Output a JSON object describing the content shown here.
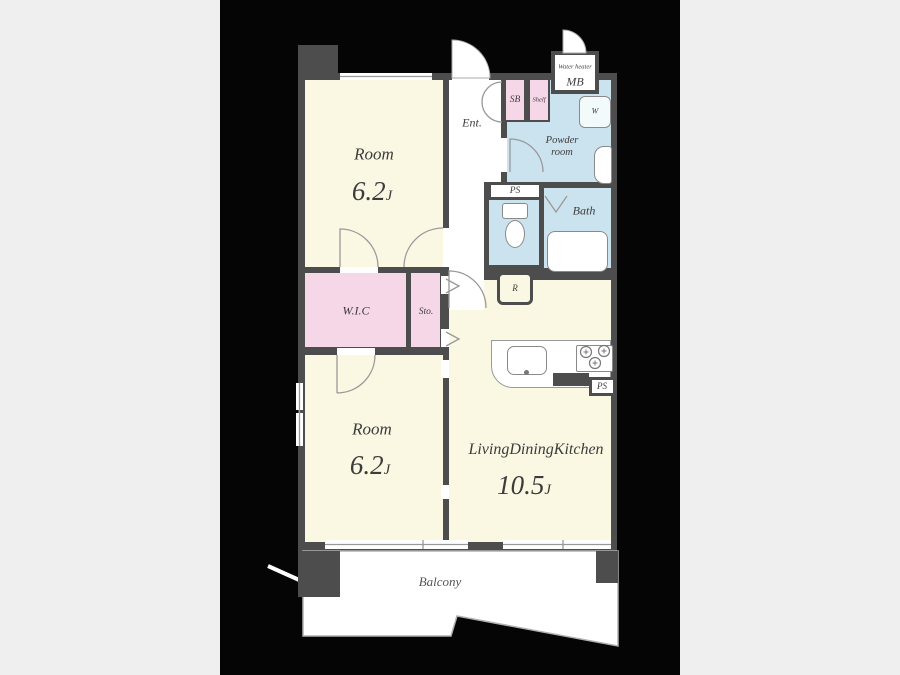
{
  "colors": {
    "canvas": "#efefef",
    "black": "#050505",
    "wall": "#4d4d4d",
    "cream": "#faf7e3",
    "pink": "#f6d7e8",
    "blue": "#cbe3ee",
    "white": "#ffffff",
    "line": "#999999",
    "text": "#3c3c3c"
  },
  "rooms": {
    "room_top": {
      "name": "Room",
      "size": "6.2",
      "unit": "J"
    },
    "room_bottom": {
      "name": "Room",
      "size": "6.2",
      "unit": "J"
    },
    "ldk": {
      "name": "LivingDiningKitchen",
      "size": "10.5",
      "unit": "J"
    },
    "wic": {
      "label": "W.I.C"
    },
    "storage": {
      "label": "Sto."
    },
    "entrance": {
      "label": "Ent."
    },
    "shoebox": {
      "label": "SB"
    },
    "shelf": {
      "label": "Shelf"
    },
    "meterbox": {
      "line1": "Water heater",
      "line2": "MB"
    },
    "powder": {
      "line1": "Powder",
      "line2": "room"
    },
    "ps_toilet": {
      "label": "PS"
    },
    "ps_kitchen": {
      "label": "PS"
    },
    "bath": {
      "label": "Bath"
    },
    "fridge": {
      "label": "R"
    },
    "washer": {
      "label": "W"
    },
    "balcony": {
      "label": "Balcony"
    }
  }
}
